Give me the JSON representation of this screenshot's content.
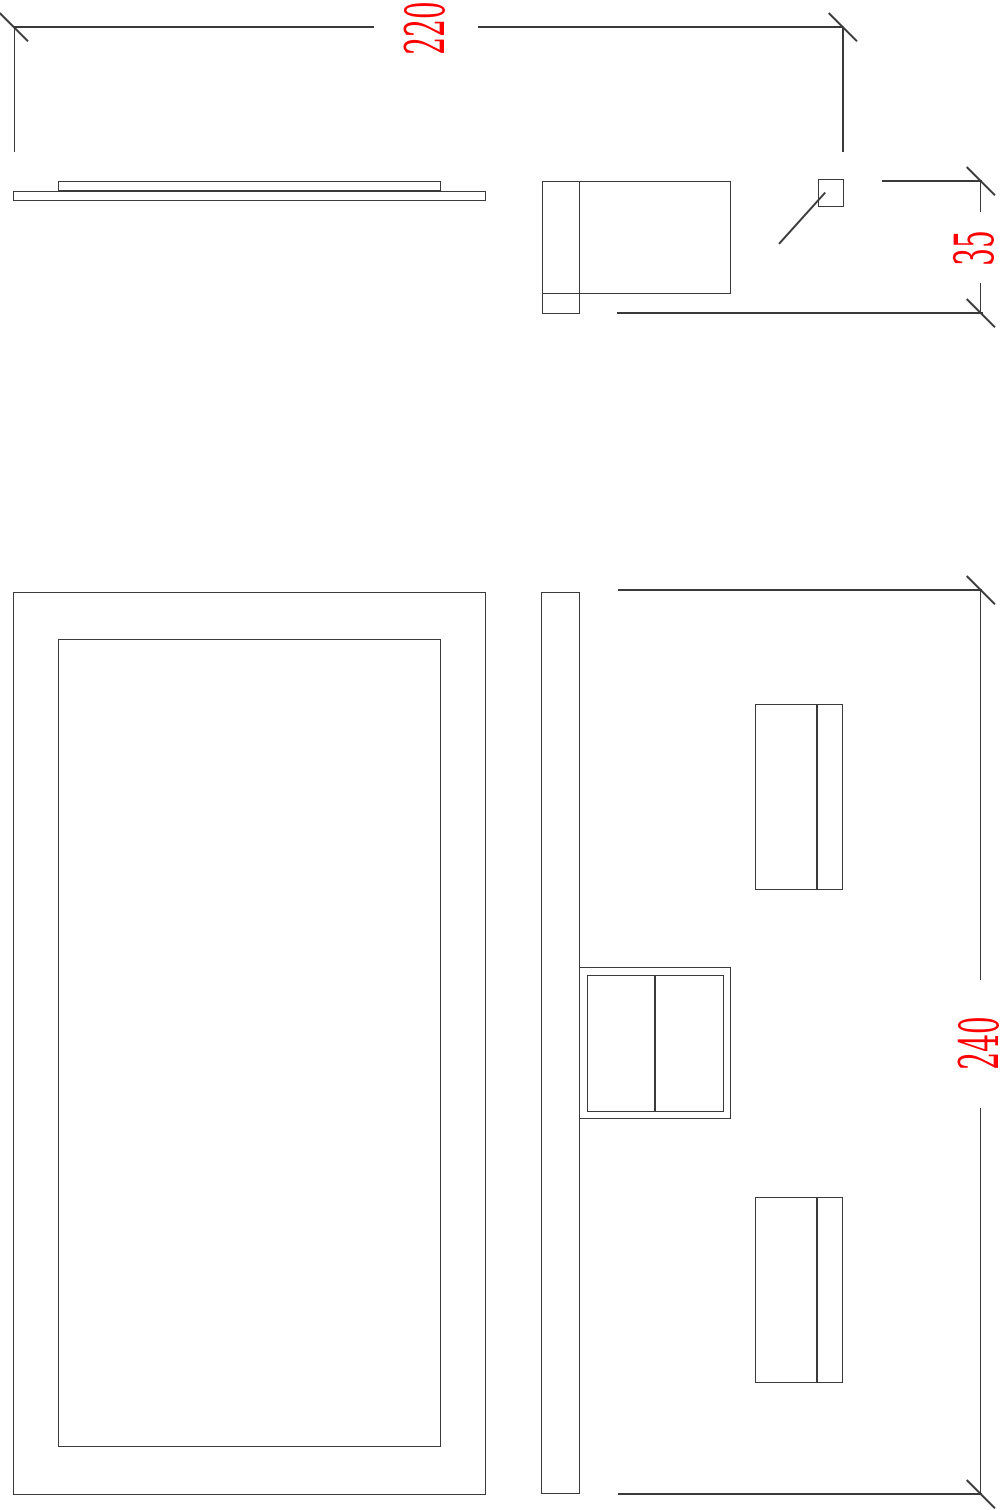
{
  "drawing": {
    "background_color": "#ffffff",
    "line_color": "#3a3a3a",
    "dimension_text_color": "#ff0000",
    "dimensions": {
      "width": {
        "value": "220"
      },
      "depth": {
        "value": "35"
      },
      "height": {
        "value": "240"
      }
    }
  }
}
